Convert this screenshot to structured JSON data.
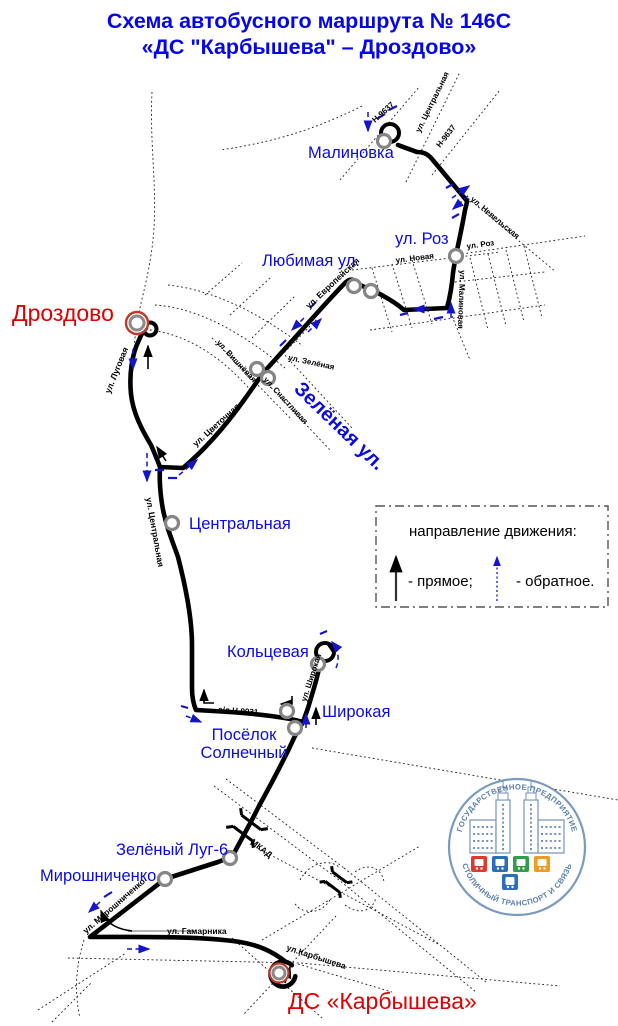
{
  "title": {
    "line1": "Схема автобусного маршрута № 146С",
    "line2": "«ДС \"Карбышева\" – Дроздово»"
  },
  "stops": {
    "malinovka": "Малиновка",
    "ul_roz": "ул. Роз",
    "lyubimaya": "Любимая ул.",
    "drozdovo": "Дроздово",
    "zelyonaya_ul": "Зелёная ул.",
    "tsentralnaya": "Центральная",
    "koltsevaya": "Кольцевая",
    "shirokaya": "Широкая",
    "posyolok_line1": "Посёлок",
    "posyolok_line2": "Солнечный",
    "zelyony_lug": "Зелёный Луг-6",
    "miroshnichenko": "Мирошниченко",
    "ds_karbysheva": "ДС «Карбышева»"
  },
  "streets": {
    "n9637_a": "Н-9637",
    "n9637_b": "Н-9637",
    "tsentralnaya_top": "ул. Центральная",
    "nevelskaya": "ул. Невельская",
    "roz": "ул. Роз",
    "novaya": "ул. Новая",
    "malinovaya": "ул. Малиновая",
    "evropeyskaya": "ул. Европейская",
    "vishnyovaya": "ул. Вишнёвая",
    "zelyonaya": "ул. Зелёная",
    "schastlivaya": "ул. Счастливая",
    "lugovaya": "ул. Луговая",
    "tsvetochnaya": "ул. Цветочная",
    "tsentralnaya_mid": "ул. Центральная",
    "ad_n9031": "а/д Н-9031",
    "shirokaya": "ул. Широкая",
    "mkad": "МКАД",
    "miroshnichenko": "ул. Мирошниченко",
    "gamarnika": "ул. Гамарника",
    "karbysheva": "ул.Карбышева"
  },
  "legend": {
    "title": "направление движения:",
    "forward": "- прямое;",
    "reverse": "- обратное."
  },
  "logo": {
    "arc_top": "ГОСУДАРСТВЕННОЕ ПРЕДПРИЯТИЕ",
    "arc_bottom": "СТОЛИЧНЫЙ ТРАНСПОРТ И СВЯЗЬ"
  },
  "colors": {
    "title_blue": "#0505EA",
    "stop_blue": "#0A0AE6",
    "terminal_red": "#DD0000",
    "route_black": "#000000",
    "reverse_blue": "#1414CC",
    "logo_text_blue": "#5C7FA8",
    "icon_red": "#E03A2F",
    "icon_blue": "#2A6FBB",
    "icon_green": "#2F9E48",
    "icon_orange": "#F59A1E"
  }
}
